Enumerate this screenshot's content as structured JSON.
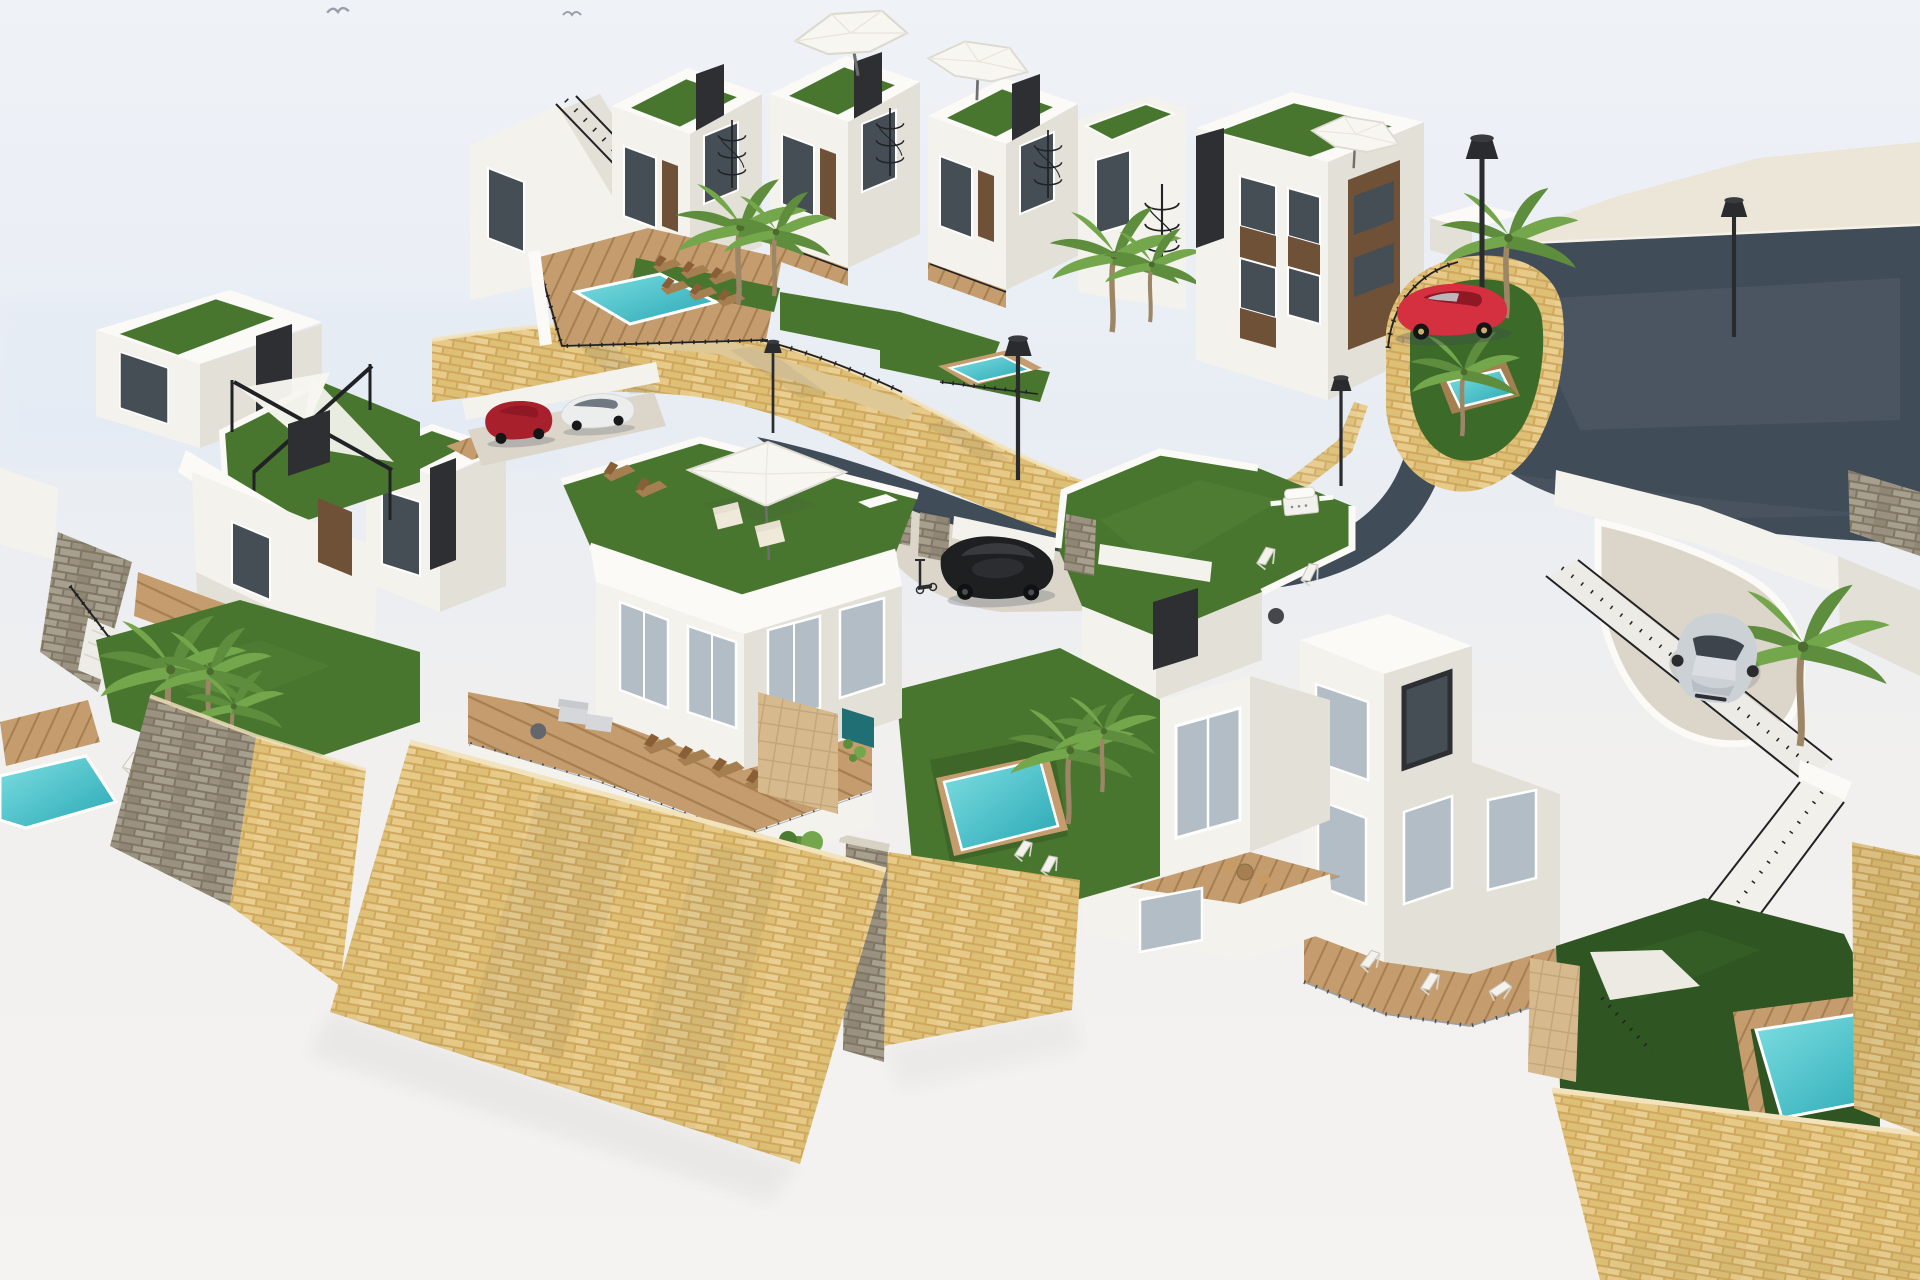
{
  "scene": {
    "type": "3d-architectural-render",
    "description": "Aerial 3D rendering of a hillside residential development: modern white villas and townhouses with rooftop lawn terraces, white parasols, timber sail pergolas, turquoise plunge pools, palm trees, sandstone retaining walls, a curved dark asphalt road with parked cars and black street lamps, on a plain white background with two seagulls in the sky.",
    "objects": [
      {
        "name": "townhouse-row",
        "label": "Row of white townhouses with roof terraces, parasols and spiral staircases"
      },
      {
        "name": "right-building",
        "label": "Three-storey white apartment building with brown window panels"
      },
      {
        "name": "center-villa",
        "label": "Detached villa with rooftop lawn terrace, square parasol and wooden sun deck"
      },
      {
        "name": "left-cluster",
        "label": "Villas with sail-shade pergola roof terrace, garden lawn and plunge pool"
      },
      {
        "name": "garden-villa",
        "label": "Villa with rooftop garden, barbecue, deck chairs and covered terrace"
      },
      {
        "name": "right-villa",
        "label": "Villa with wooden deck, sun loungers, lawn garden and plunge pool"
      },
      {
        "name": "roof-pool-terrace",
        "label": "Shared terrace with swimming pool, sun loungers and palm trees"
      },
      {
        "name": "planter-garden",
        "label": "Curved stone planter with palm trees and plunge pool"
      },
      {
        "name": "road",
        "label": "Curved asphalt access road and parking area"
      },
      {
        "name": "red-car",
        "label": "Red SUV parked on the road"
      },
      {
        "name": "black-car",
        "label": "Black car parked in lower courtyard"
      },
      {
        "name": "red-suv",
        "label": "Dark red SUV in upper car park"
      },
      {
        "name": "white-coupe",
        "label": "White sports car in upper car park"
      },
      {
        "name": "silver-car",
        "label": "Silver hatchback on private driveway"
      },
      {
        "name": "street-lamps",
        "label": "Black street lamps",
        "count": 5
      },
      {
        "name": "stone-walls",
        "label": "Sandstone and grey stone retaining walls"
      },
      {
        "name": "pools",
        "label": "Turquoise swimming pools",
        "count": 6
      },
      {
        "name": "palm-trees",
        "label": "Palm trees"
      },
      {
        "name": "pergolas",
        "label": "Timber pergolas with white shade sails",
        "count": 2
      },
      {
        "name": "parasols",
        "label": "White parasols",
        "count": 3
      },
      {
        "name": "stairs",
        "label": "Outdoor staircases with black railings"
      },
      {
        "name": "seagulls",
        "label": "Seagulls flying",
        "count": 2
      },
      {
        "name": "scooter",
        "label": "Electric scooter"
      },
      {
        "name": "bbq",
        "label": "Outdoor barbecue grill"
      }
    ]
  },
  "palette": {
    "sky_top": "#eff2f7",
    "sky_low": "#e8edf4",
    "ground": "#f2f0ee",
    "ground_low": "#f5f3f1",
    "white_top": "#fbfaf7",
    "white_front": "#f4f2ec",
    "white_side": "#e3e0d8",
    "white_deep": "#d6d2c8",
    "panel_dark": "#2e2f33",
    "panel_brown": "#6e5137",
    "glass_dark": "#454d55",
    "glass_light": "#b3bdc6",
    "grass": "#49762e",
    "grass_light": "#5f9140",
    "grass_dark": "#2e5522",
    "pool_light": "#7edfe2",
    "pool_deep": "#28a7b4",
    "wood": "#c49c6d",
    "wood_dark": "#a57f50",
    "stone_base_y": "#cfa85e",
    "stone_brick_y1": "#e7ca88",
    "stone_brick_y2": "#ddbf75",
    "stone_brick_y3": "#e9d092",
    "stone_base_g": "#7f7664",
    "stone_brick_g1": "#9b9180",
    "stone_brick_g2": "#a8a08e",
    "stone_brick_g3": "#8f8674",
    "tile_beige": "#d6ba8e",
    "tile_line": "#c3a577",
    "road": "#414c59",
    "sidewalk": "#ece6d9",
    "concrete": "#dcd6ca",
    "railing": "#212225",
    "metal": "#2a2b2e",
    "canvas": "#f7f6f1",
    "car_red": "#d5303f",
    "car_red_dark": "#8e1824",
    "car_suv": "#a8202c",
    "car_silver": "#ccd1d6",
    "car_dark": "#1e1f21",
    "trunk": "#9c8666",
    "frond_a": "#5e8e3d",
    "frond_b": "#74a74c",
    "shadow": "#3c465a"
  }
}
